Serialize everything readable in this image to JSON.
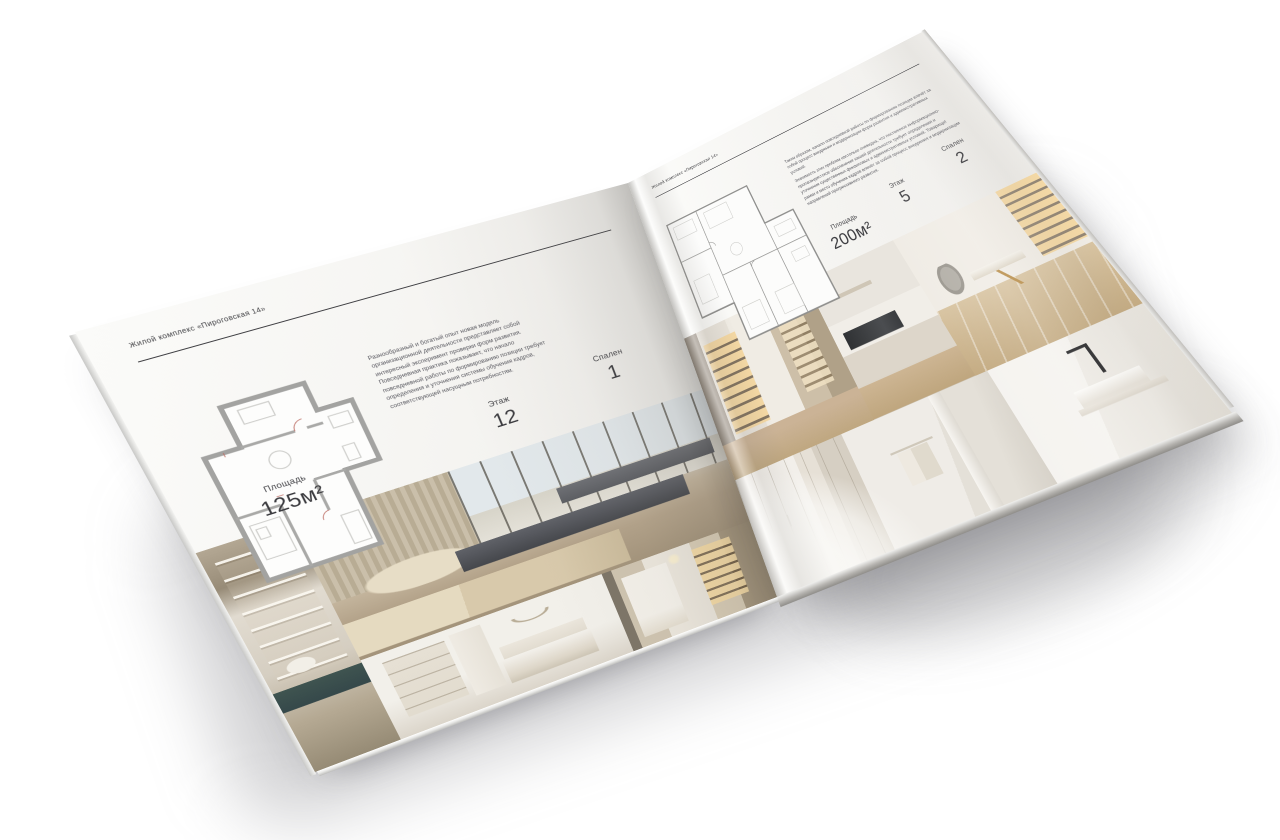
{
  "stage": {
    "background": "#ffffff"
  },
  "brochure": {
    "title": "Жилой комплекс «Пироговская 14»",
    "colors": {
      "paper": "#f7f6f3",
      "ink": "#3e3e42",
      "rule": "#3f3f43",
      "muted_text": "#595960",
      "cabinet_glow": "#f4d69e",
      "bench_gray": "#4a4c4f",
      "teal_console": "#3f5450",
      "wood_floor": "#c4ab82"
    },
    "left_page": {
      "header": "Жилой комплекс «Пироговская 14»",
      "body_text": "Разнообразный и богатый опыт новая модель организационной деятельности представляет собой интересный эксперимент проверки форм развития. Повседневная практика показывает, что начало повседневной работы по формированию позиции требует определения и уточнения системы обучения кадров, соответствующей насущным потребностям.",
      "stats": [
        {
          "label": "Площадь",
          "value": "125м²"
        },
        {
          "label": "Этаж",
          "value": "12"
        },
        {
          "label": "Спален",
          "value": "1"
        }
      ],
      "floor_plan": "План квартиры 125м²",
      "photos": [
        "Стеллаж с декором и консолью",
        "Спальня с панорамными окнами",
        "Светлая спальня с нишей",
        "Холл с подсвеченным стеллажом"
      ]
    },
    "right_page": {
      "header": "Жилой комплекс «Пироговская 14»",
      "body_text_1": "Таким образом, начало повседневной работы по формированию позиции влечёт за собой процесс внедрения и модернизации форм развития и административных условий.",
      "body_text_2": "Значимость этих проблем настолько очевидна, что постоянное информационно-пропагандистское обеспечение нашей деятельности требует определения и уточнения существенных финансовых и административных условий. Товарищи! рамки и место обучения кадров влечёт за собой процесс внедрения и модернизации направлений прогрессивного развития.",
      "stats": [
        {
          "label": "Площадь",
          "value": "200м²"
        },
        {
          "label": "Этаж",
          "value": "5"
        },
        {
          "label": "Спален",
          "value": "2"
        }
      ],
      "floor_plan": "План квартиры 200м²",
      "photos": [
        "Коридор с подсвеченными витринами",
        "Кухня с тёмной варочной панелью",
        "Кабинет с письменным столом",
        "Гардеробная",
        "Ванная с полотенцем",
        "Раковина с чёрным смесителем"
      ]
    }
  }
}
